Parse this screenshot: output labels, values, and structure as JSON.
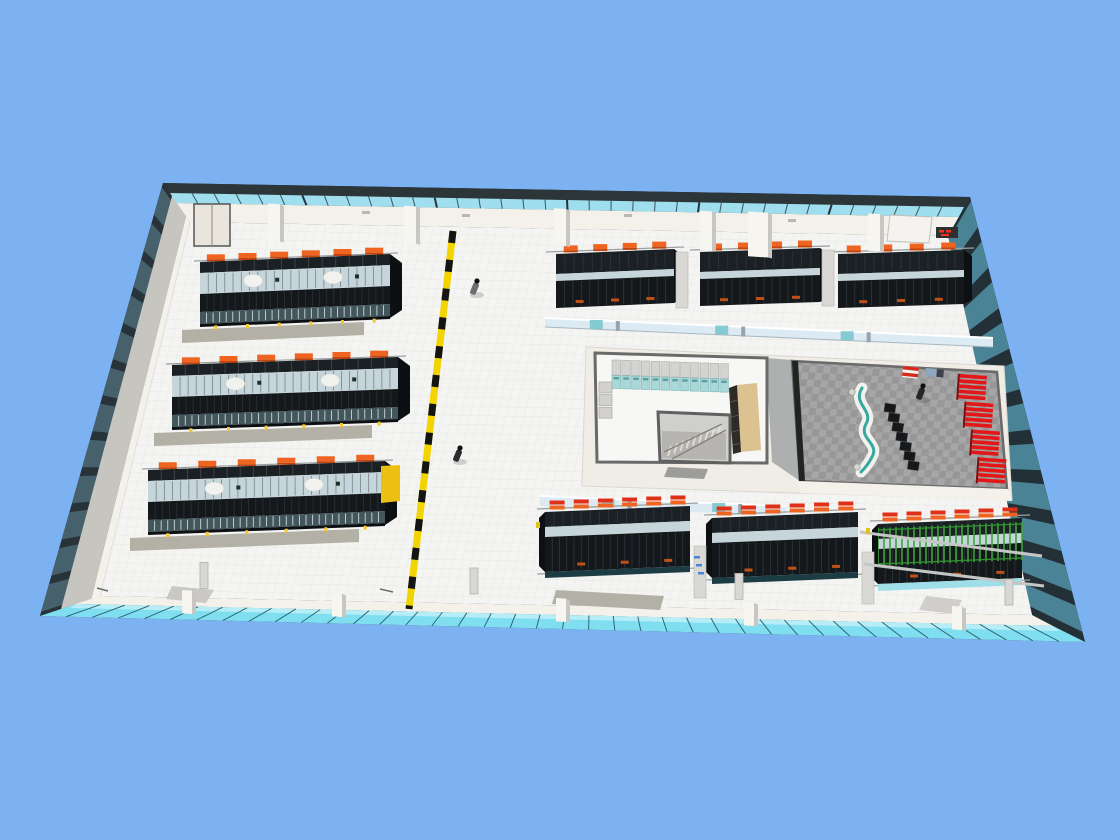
{
  "colors": {
    "sky": "#7db2f2",
    "roofEdge": "#2c3639",
    "clerestory": "#9fdeee",
    "mullion": "#3a545c",
    "wallWhite": "#f3f1ea",
    "wallGray": "#c6c5c0",
    "leftDark": "#273239",
    "leftPanel": "#46616c",
    "rightBase": "#233037",
    "rightGlass": "#4a8395",
    "bottomGlass": "#7fdff0",
    "bottomGlassLight": "#b7edf7",
    "bottomMullion": "#2e6673",
    "floor": "#f4f4f3",
    "floorGrid": "#e3e3e2",
    "rackBlack": "#1a2024",
    "rackFace": "#14181b",
    "rackRib": "#2e3a40",
    "glassRoof": "#c6d5da",
    "glassRib": "#72848c",
    "slat": "#42565c",
    "slatRib": "#cdd8da",
    "tray": "#ef6420",
    "trayDark": "#c2440f",
    "trayRed": "#e03018",
    "hazardY": "#f2d400",
    "hazardK": "#141414",
    "mat": "#b3b0a5",
    "yellowBox": "#ecc013",
    "plinth": "#efede6",
    "roomWall": "#6a6a6a",
    "roomFloor": "#f7f7f5",
    "cabinet": "#d3d4d2",
    "cabTeal": "#a8d8d8",
    "shelf": "#dcc291",
    "shelfDark": "#2e2a26",
    "stair": "#cfcfcc",
    "stairIn": "#b5b4b1",
    "carpet": "#979797",
    "carpetCheck": "#a6a6a6",
    "seatRed": "#e31717",
    "chair": "#16181a",
    "deskTeal": "#35a8a2",
    "green": "#3da53a",
    "corridor": "#dcebf3",
    "corridorTeal": "#7ac6cd",
    "person": "#2b2b2b",
    "boothWhite": "#f5f3ef",
    "led": "#2f2f2f",
    "ledRed": "#ff2d1a"
  },
  "scene": {
    "people_count": 3,
    "left_rack_rows": 3,
    "top_right_rack_rows": 3,
    "bottom_right_rack_rows": 3,
    "green_caged_rows": 1,
    "trays_per_left_row": 6,
    "trays_per_top_row": 4,
    "trays_per_bottom_row": 6,
    "hazard_lane_style": "yellow-black",
    "central_room": {
      "cabinets": 12,
      "gray_boxes": 3,
      "has_stairwell": true,
      "tan_shelves": 1
    },
    "presentation_room": {
      "red_seat_banks": 4,
      "seat_rows_per_bank": 5,
      "black_chairs": 7,
      "reception_desks": 1
    }
  }
}
